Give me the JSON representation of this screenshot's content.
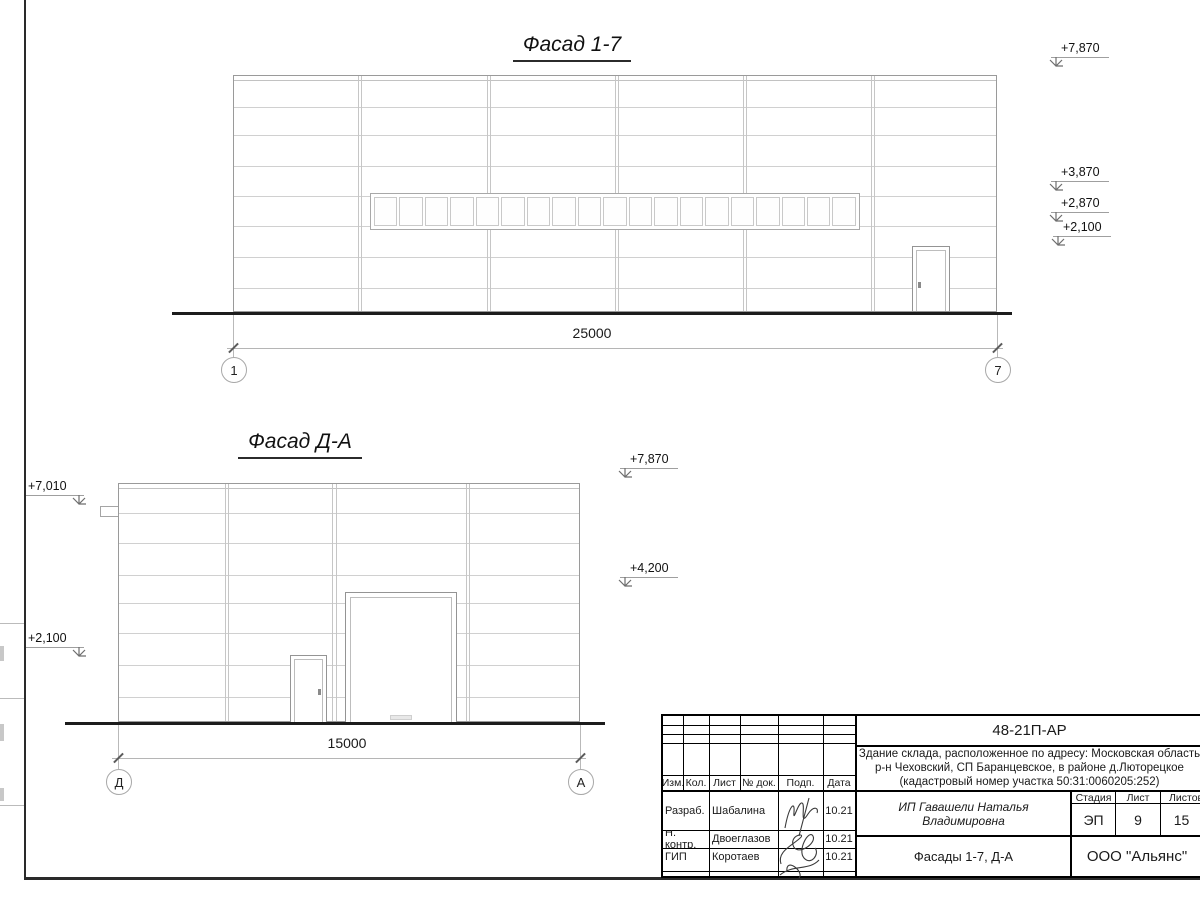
{
  "facade_1_7": {
    "title": "Фасад 1-7",
    "dimension_label": "25000",
    "axis_start": "1",
    "axis_end": "7",
    "elev_roof": "+7,870",
    "elev_window_top": "+3,870",
    "elev_window_bottom": "+2,870",
    "elev_door_top": "+2,100"
  },
  "facade_d_a": {
    "title": "Фасад Д-А",
    "dimension_label": "15000",
    "axis_start": "Д",
    "axis_end": "А",
    "elev_left_top": "+7,010",
    "elev_left_door": "+2,100",
    "elev_right_roof": "+7,870",
    "elev_right_gate": "+4,200"
  },
  "title_block": {
    "doc_number": "48-21П-АР",
    "description_line1": "Здание склада, расположенное по адресу: Московская область",
    "description_line2": "р-н Чеховский, СП Баранцевское, в районе д.Люторецкое",
    "description_line3": "(кадастровый номер участка 50:31:0060205:252)",
    "columns": [
      "Изм.",
      "Кол.",
      "Лист",
      "№ док.",
      "Подп.",
      "Дата"
    ],
    "rows": [
      {
        "role": "Разраб.",
        "name": "Шабалина",
        "date": "10.21"
      },
      {
        "role": "Н. контр.",
        "name": "Двоеглазов",
        "date": "10.21"
      },
      {
        "role": "ГИП",
        "name": "Коротаев",
        "date": "10.21"
      }
    ],
    "client": "ИП Гавашели Наталья Владимировна",
    "stage_label": "Стадия",
    "sheet_label": "Лист",
    "sheets_label": "Листов",
    "stage_value": "ЭП",
    "sheet_value": "9",
    "sheets_value": "15",
    "sheet_title": "Фасады 1-7, Д-А",
    "organization": "ООО \"Альянс\""
  },
  "colors": {
    "panel_joint": "#d0d0d0",
    "outline": "#9a9a9a",
    "ground": "#1c1c1c",
    "text": "#1a1a1a"
  }
}
